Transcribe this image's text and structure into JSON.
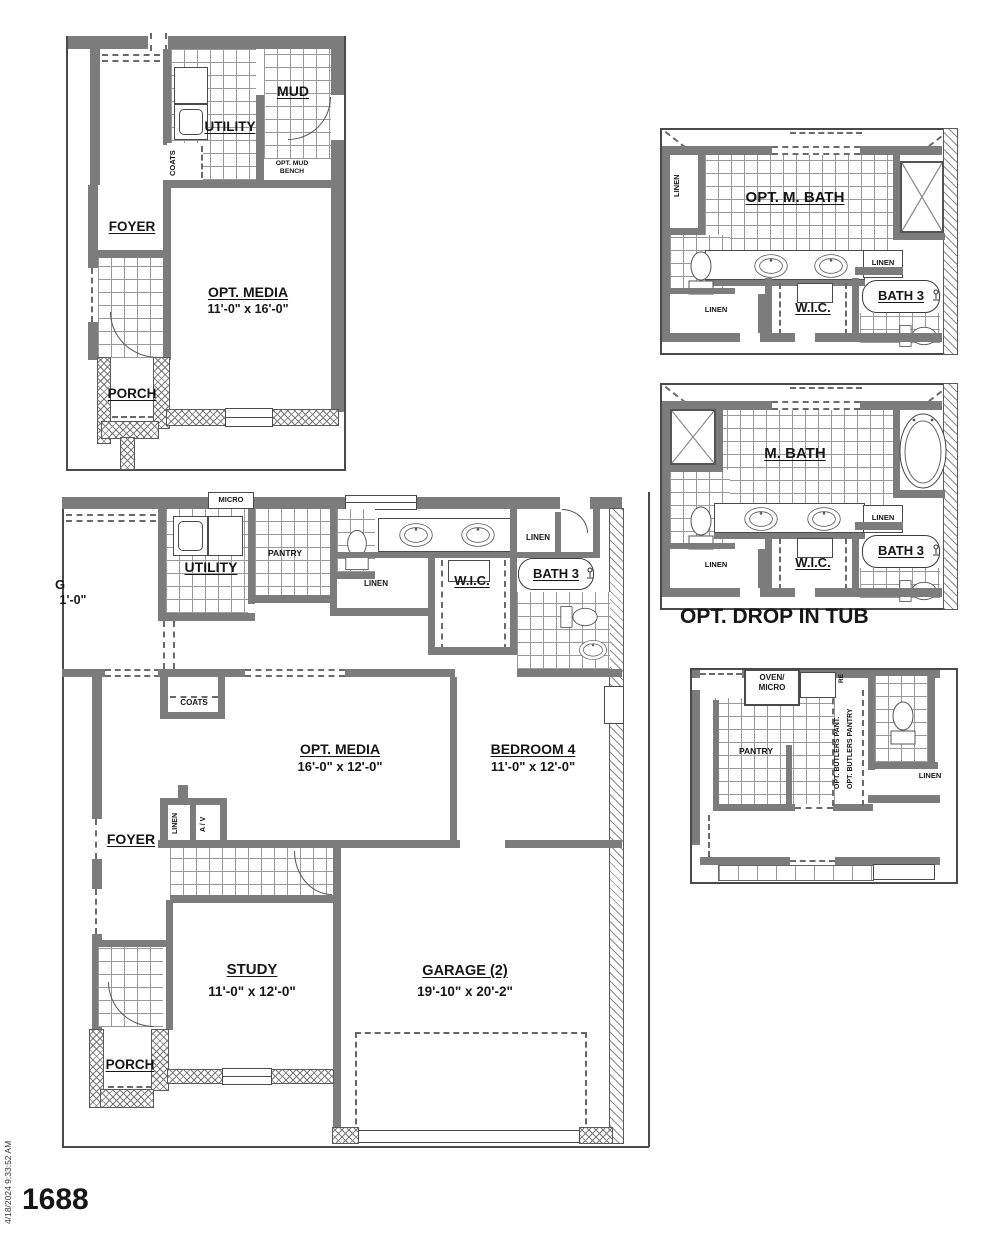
{
  "colors": {
    "wall": "#7c7c7c",
    "line": "#4a4a4a",
    "text": "#161616",
    "hatch": "#787878"
  },
  "footer": {
    "plan_number": "1688",
    "timestamp": "4/18/2024 9:33:52 AM"
  },
  "plan_a": {
    "mud": "MUD",
    "utility": "UTILITY",
    "coats": "COATS",
    "opt_mud_1": "OPT. MUD",
    "opt_mud_2": "BENCH",
    "foyer": "FOYER",
    "media": "OPT. MEDIA",
    "media_dim": "11'-0\" x 16'-0\"",
    "porch": "PORCH"
  },
  "plan_b": {
    "title": "OPT. M. BATH",
    "linen_tl": "LINEN",
    "linen_r": "LINEN",
    "linen_b": "LINEN",
    "wic": "W.I.C.",
    "bath3": "BATH 3"
  },
  "plan_c": {
    "title": "M. BATH",
    "linen_r": "LINEN",
    "linen_b": "LINEN",
    "wic": "W.I.C.",
    "bath3": "BATH 3",
    "caption": "OPT. DROP IN TUB"
  },
  "plan_d": {
    "oven_1": "OVEN/",
    "oven_2": "MICRO",
    "pantry": "PANTRY",
    "butlers_1": "OPT. BUTLERS PANT.",
    "butlers_2": "OPT. BUTLERS PANTRY",
    "ref": "RE",
    "linen": "LINEN"
  },
  "main": {
    "micro": "MICRO",
    "utility": "UTILITY",
    "pantry": "PANTRY",
    "linen_top": "LINEN",
    "wic": "W.I.C.",
    "bath3": "BATH 3",
    "linen_mid": "LINEN",
    "clip_g": "G",
    "clip_dim": "1'-0\"",
    "coats": "COATS",
    "media": "OPT. MEDIA",
    "media_dim": "16'-0\" x 12'-0\"",
    "bed4": "BEDROOM 4",
    "bed4_dim": "11'-0\" x 12'-0\"",
    "linen_cl": "LINEN",
    "av": "A / V",
    "foyer": "FOYER",
    "study": "STUDY",
    "study_dim": "11'-0\" x 12'-0\"",
    "garage": "GARAGE (2)",
    "garage_dim": "19'-10\" x 20'-2\"",
    "porch": "PORCH"
  }
}
